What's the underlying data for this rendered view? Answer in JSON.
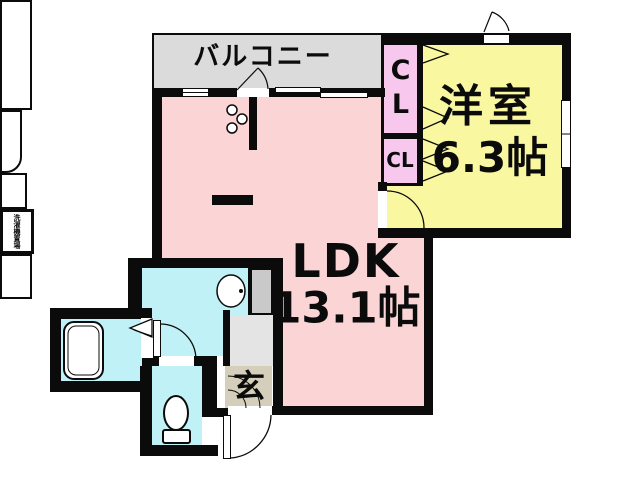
{
  "plan": {
    "balcony": {
      "label": "バルコニー"
    },
    "western_room": {
      "label": "洋室",
      "size": "6.3帖"
    },
    "ldk": {
      "label": "LDK",
      "size": "13.1帖"
    },
    "closet_upper": {
      "line1": "C",
      "line2": "L"
    },
    "closet_lower": {
      "label": "CL"
    },
    "entrance": {
      "label": "玄"
    },
    "laundry": {
      "label": "洗濯機置場"
    },
    "colors": {
      "wall": "#0b0b0b",
      "balcony_fill": "#dbdbdb",
      "ldk_fill": "#fbd5d5",
      "western_room_fill": "#f9f8a0",
      "closet_fill": "#f8c7ee",
      "wet_area_fill": "#bff1f7",
      "entrance_tile_fill": "#d4cebb",
      "hall_fill": "#e4e4e4",
      "pipe_space_fill": "#c9c9c9"
    }
  }
}
